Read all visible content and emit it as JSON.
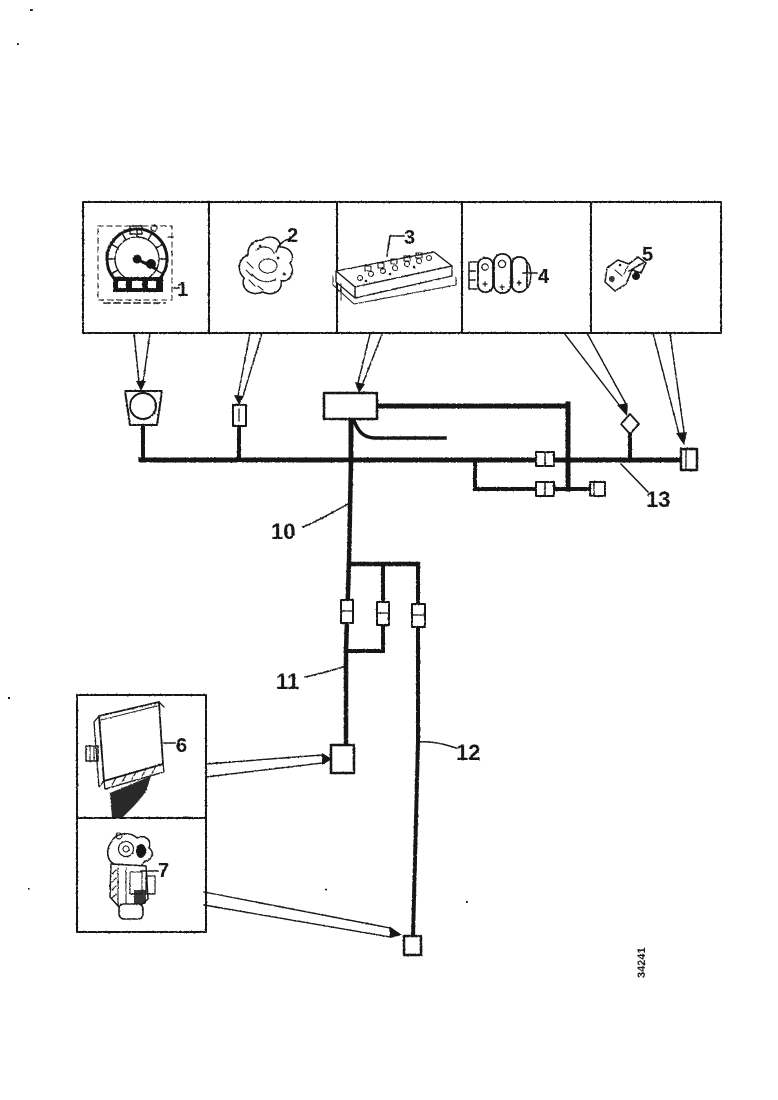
{
  "page": {
    "background": "#ffffff",
    "ink": "#141414"
  },
  "figure_code": "34241",
  "callouts": {
    "c1": "1",
    "c2": "2",
    "c3": "3",
    "c4": "4",
    "c5": "5",
    "c6": "6",
    "c7": "7",
    "c10": "10",
    "c11": "11",
    "c12": "12",
    "c13": "13"
  }
}
